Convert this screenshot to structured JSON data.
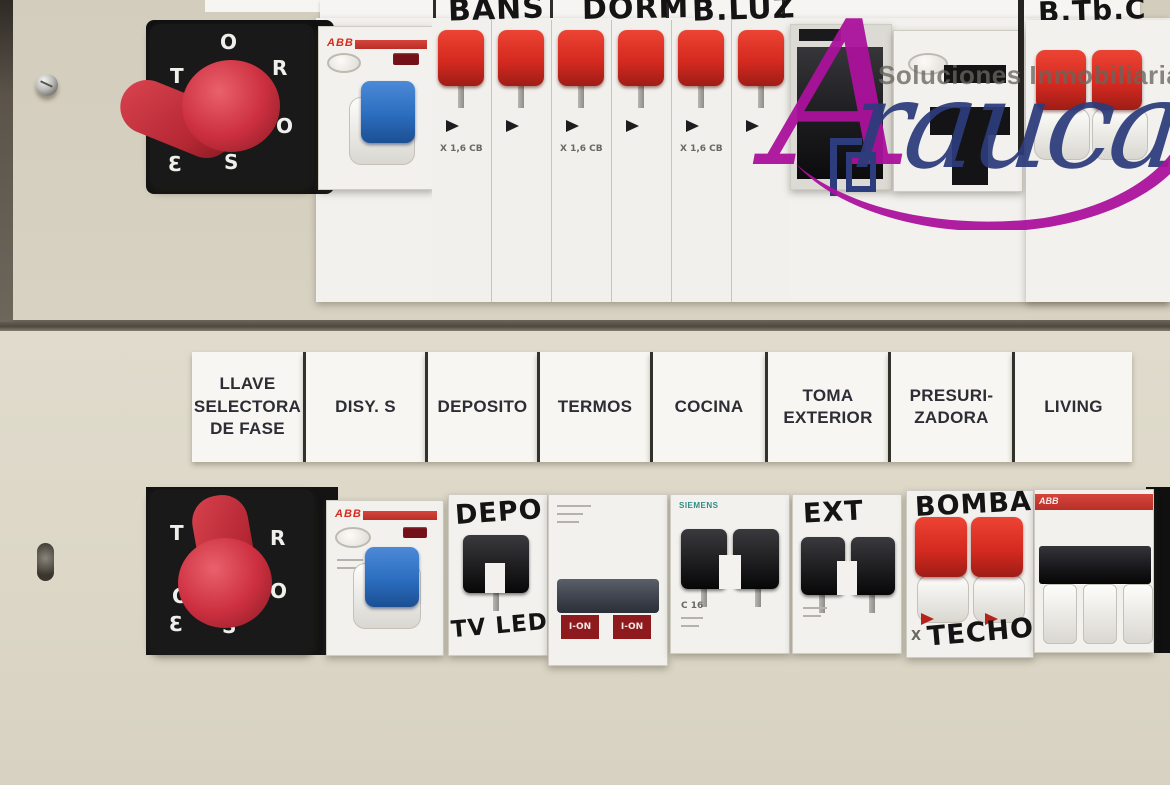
{
  "brand": {
    "tagline": "Soluciones Inmobiliarias",
    "name_initial": "A",
    "name_rest": "rauca"
  },
  "colors": {
    "magenta": "#ab119c",
    "navy": "#2c3c7c",
    "abb_red": "#d62b1f",
    "toggle_red": "#d52a20",
    "toggle_blue": "#2b6dbf",
    "wall_beige": "#d8d2c2"
  },
  "top_row": {
    "selector_letters": [
      "O",
      "R",
      "O",
      "S",
      "T",
      "Ɛ"
    ],
    "handwritten": [
      "BAÑS",
      "DORM",
      "B.LUZ",
      "B.Tb.C"
    ],
    "abb_logo": "ABB",
    "x_rating": "X 1,6 CB"
  },
  "label_strip": {
    "items": [
      "LLAVE\nSELECTORA\nDE FASE",
      "DISY. S",
      "DEPOSITO",
      "TERMOS",
      "COCINA",
      "TOMA\nEXTERIOR",
      "PRESURI-\nZADORA",
      "LIVING"
    ]
  },
  "bottom_row": {
    "selector_letters": [
      "T",
      "R",
      "O",
      "O",
      "S",
      "Ɛ"
    ],
    "abb_logo": "ABB",
    "siemens_logo": "SIEMENS",
    "handwritten": {
      "deposito_top": "DEPO",
      "deposito_bottom": "TV LED",
      "exterior": "EXT",
      "bomba": "BOMBA",
      "techo": "TECHO"
    },
    "indicators": {
      "ion": "I-ON",
      "c16": "C 16",
      "x_mark": "X"
    }
  }
}
